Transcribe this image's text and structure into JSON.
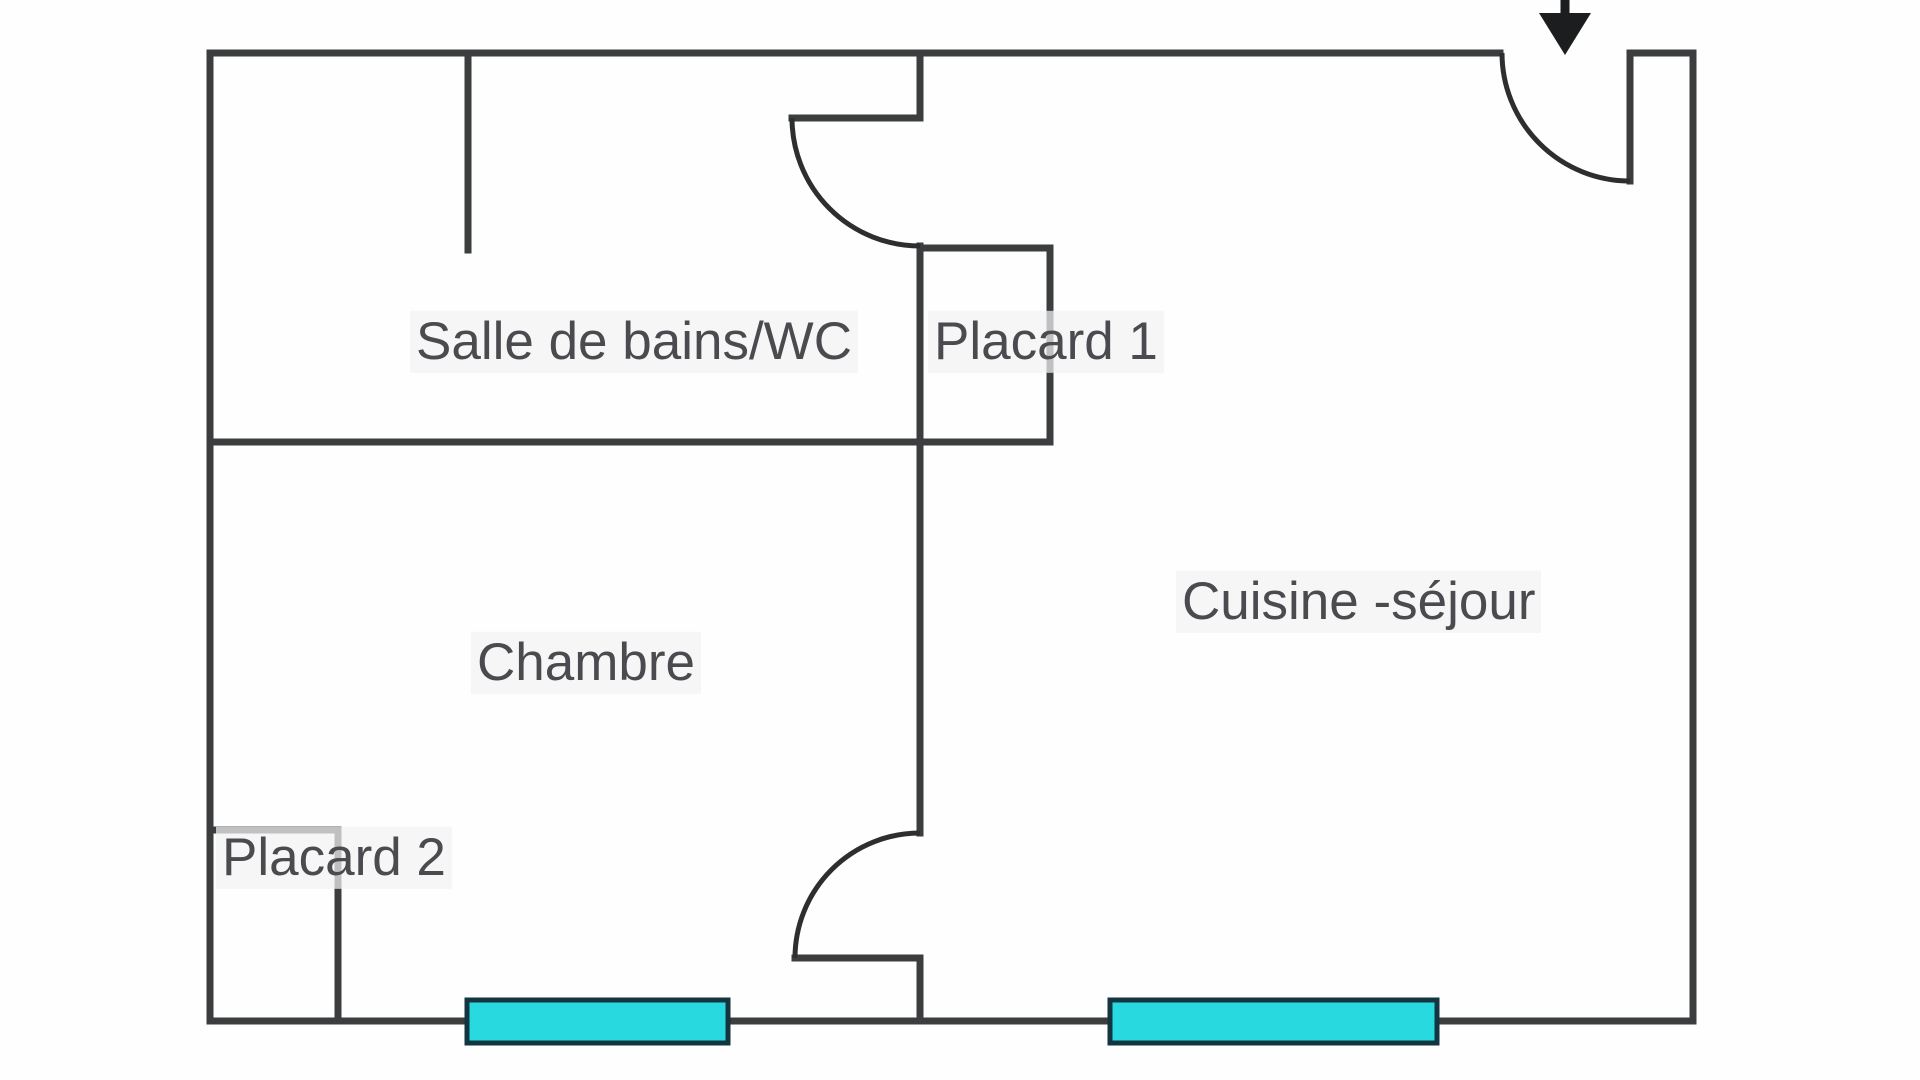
{
  "plan": {
    "labels": {
      "bathroom": "Salle de bains/WC",
      "closet1": "Placard 1",
      "bedroom": "Chambre",
      "closet2": "Placard 2",
      "kitchen_living": "Cuisine -séjour"
    },
    "colors": {
      "wall": "#3b3d3f",
      "door_swing": "#2c2e30",
      "window_fill": "#29d9e0",
      "window_border": "#123540",
      "label_text": "#4b4b4f",
      "label_halo": "rgba(242,243,244,0.72)",
      "arrow": "#1b1d1f",
      "background": "#fefefe"
    }
  }
}
